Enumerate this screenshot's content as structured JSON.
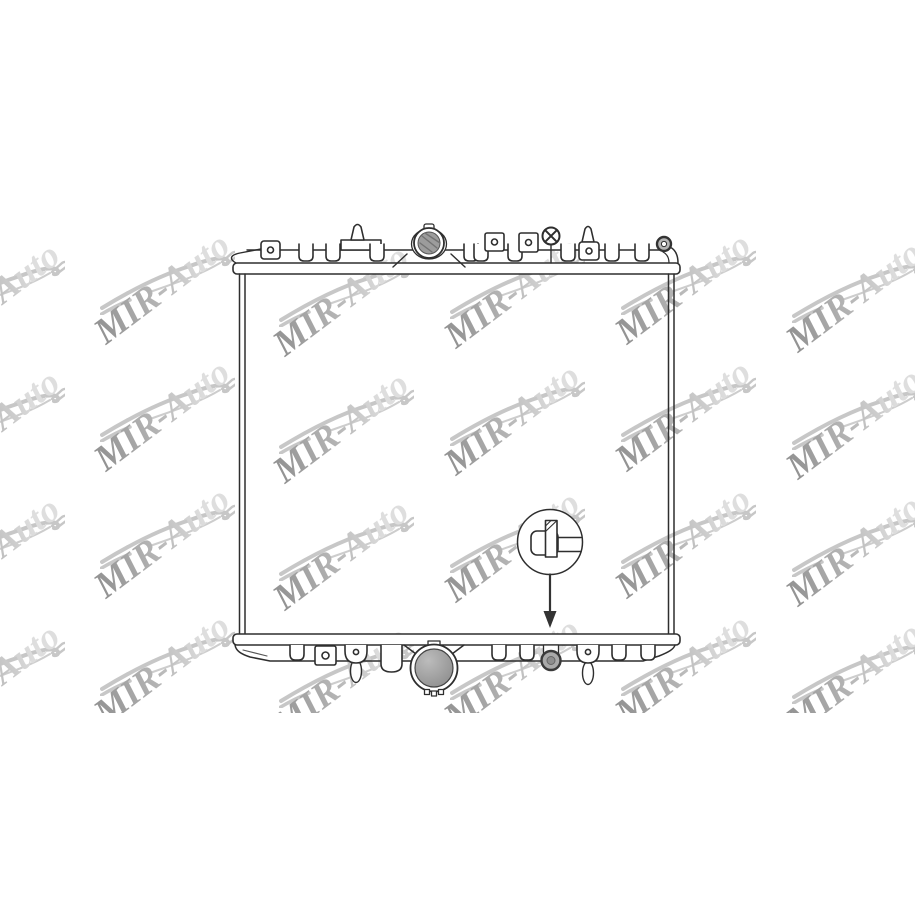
{
  "page": {
    "description": "Auto-parts catalog product image: technical line drawing of a car radiator (front view) with repeated MIR-Auto watermarks",
    "background_color": "#ffffff"
  },
  "watermark": {
    "text": "MIR-Auto",
    "rotation_deg": -37,
    "gradient_start": "#8f8f8f",
    "gradient_mid": "#b5b5b5",
    "gradient_end": "#dedede",
    "swoosh_color": "#c7c7c7",
    "area_top_px": 205,
    "area_height_px": 508,
    "columns_x": [
      -60,
      110,
      289,
      460,
      631,
      802
    ],
    "column_y_offset": [
      10,
      0,
      12,
      4,
      0,
      8
    ],
    "rows_text_bottom_y": [
      351,
      478,
      605,
      732
    ]
  },
  "drawing": {
    "type": "technical-line-drawing",
    "subject": "radiator",
    "line_color": "#2e2e2e",
    "body_fill": "#ffffff",
    "shaded_fill": "#9c9c9c",
    "parts": [
      "top-tank",
      "filler-cap",
      "vent-plug-x",
      "mounting-pin-left",
      "mounting-pin-right",
      "side-brackets",
      "radiator-core",
      "bottom-tank",
      "outlet-port",
      "drain-plug",
      "drain-plug-detail-callout",
      "callout-arrow"
    ]
  }
}
